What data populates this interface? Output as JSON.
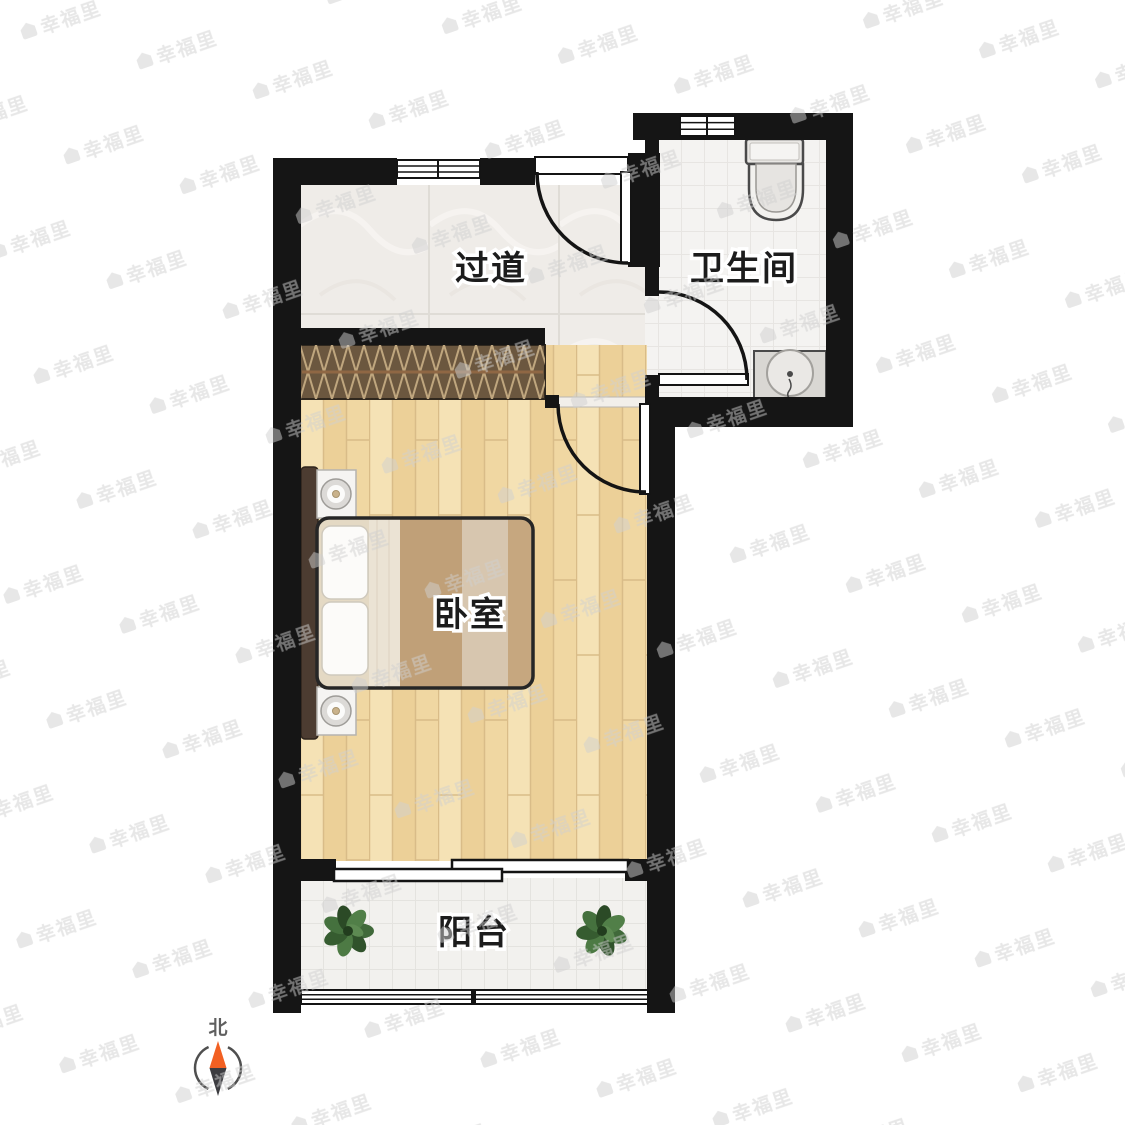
{
  "floorplan": {
    "rooms": [
      {
        "id": "hallway",
        "label": "过道"
      },
      {
        "id": "bathroom",
        "label": "卫生间"
      },
      {
        "id": "bedroom",
        "label": "卧室"
      },
      {
        "id": "balcony",
        "label": "阳台"
      }
    ],
    "compass": {
      "north_label": "北"
    },
    "watermark": {
      "text": "幸福里"
    },
    "fixtures": [
      "wardrobe",
      "double-bed",
      "nightstand",
      "nightstand",
      "toilet",
      "washbasin",
      "plant",
      "plant"
    ],
    "colors": {
      "wall": "#151515",
      "hallway_tile": "#efece8",
      "bathroom_tile": "#f4f3f1",
      "bedroom_wood_floor": "#f0d7a2",
      "balcony_tile": "#f2f1ee",
      "wardrobe_brown": "#6b573f",
      "bed_stripe_dark": "#c0a078",
      "bed_stripe_light": "#d7c6af",
      "compass_north_orange": "#f26022",
      "plant_green": "#40693a",
      "label_text": "#1c1c1c",
      "label_halo": "#ffffff",
      "watermark_gray": "#cfcfcf"
    }
  }
}
